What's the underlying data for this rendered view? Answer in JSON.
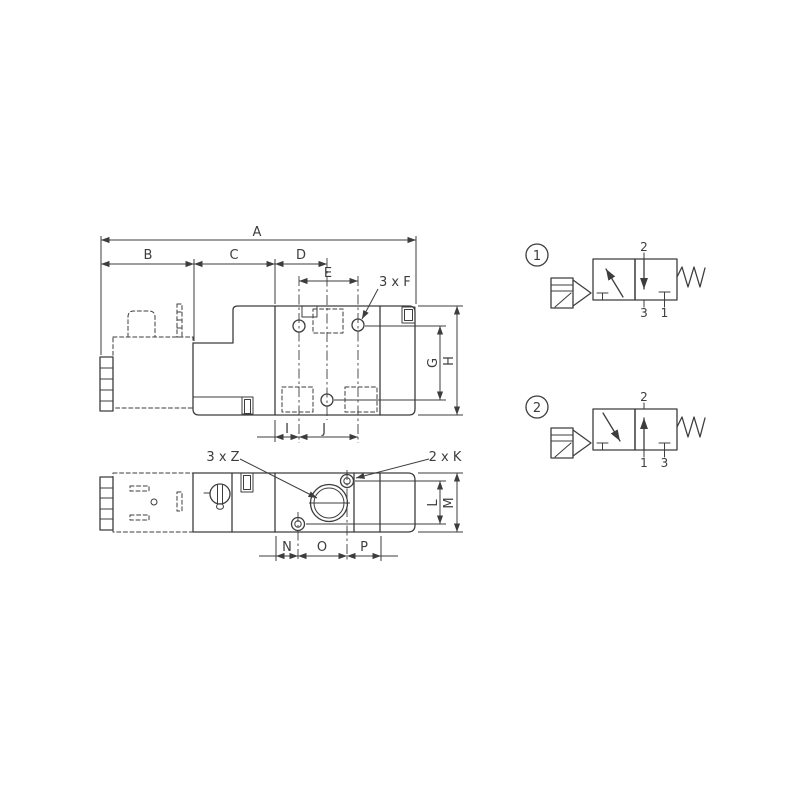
{
  "drawing": {
    "colors": {
      "line": "#3d3d3d",
      "background": "#ffffff"
    },
    "top_view": {
      "dims": {
        "A": "A",
        "B": "B",
        "C": "C",
        "D": "D",
        "E": "E",
        "F": "3 x F",
        "G": "G",
        "H": "H",
        "I": "I",
        "J": "J"
      }
    },
    "bottom_view": {
      "dims": {
        "Z": "3 x Z",
        "K": "2 x K",
        "L": "L",
        "M": "M",
        "N": "N",
        "O": "O",
        "P": "P"
      }
    },
    "symbols": [
      {
        "number": "1",
        "port_top": "2",
        "port_bottom_left": "3",
        "port_bottom_right": "1"
      },
      {
        "number": "2",
        "port_top": "2",
        "port_bottom_left": "1",
        "port_bottom_right": "3"
      }
    ]
  }
}
